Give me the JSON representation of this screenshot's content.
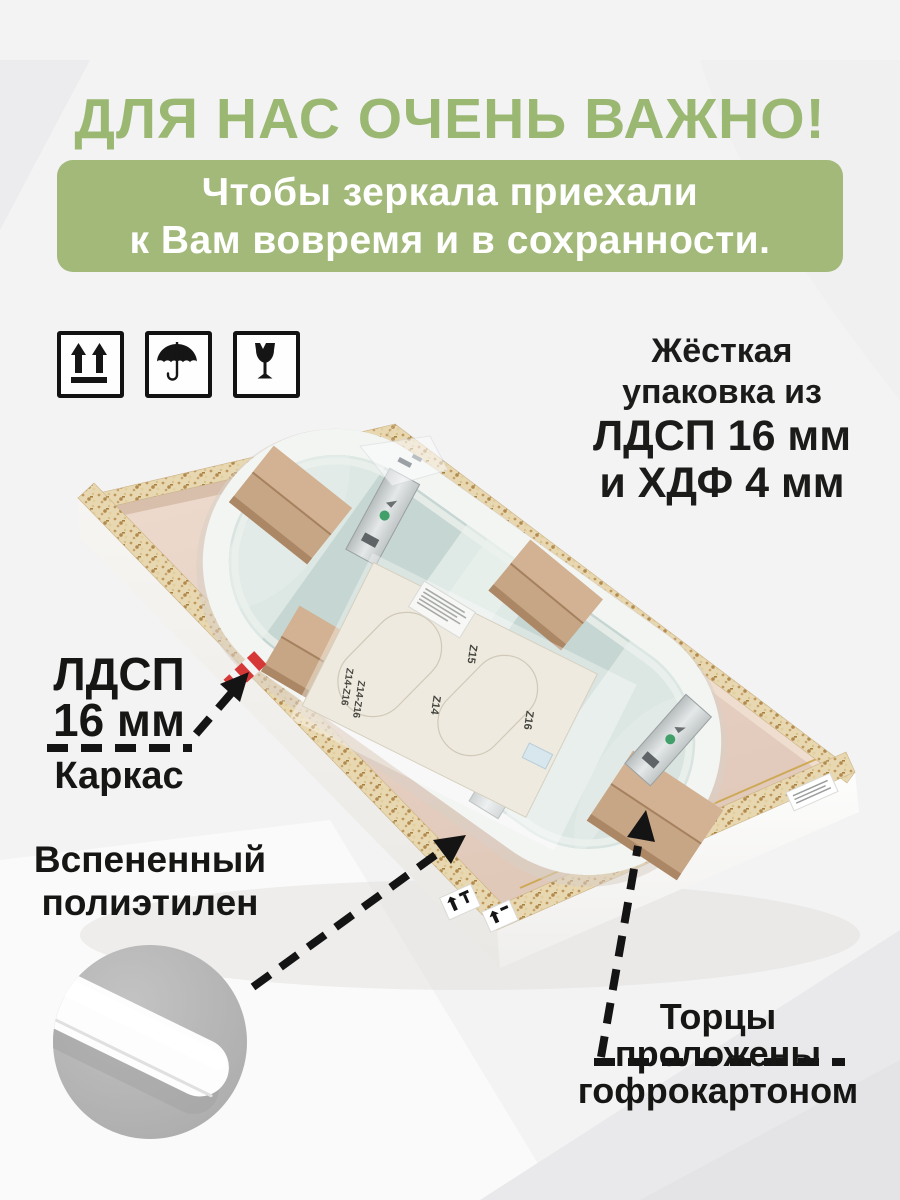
{
  "colors": {
    "accent_green": "#9bb873",
    "banner_green": "#a2b97a",
    "text_dark": "#1b1b19",
    "mirror_back": "#c6d6d2",
    "foam_white": "#f3f5f3",
    "cardboard": "#c7a685",
    "chipboard": "#e8d8b2"
  },
  "header": {
    "title": "ДЛЯ НАС ОЧЕНЬ ВАЖНО!",
    "banner_line1": "Чтобы зеркала приехали",
    "banner_line2": "к Вам вовремя и в сохранности."
  },
  "handling_icons": {
    "this_way_up": "this-way-up",
    "keep_dry": "keep-dry-umbrella",
    "fragile": "fragile-glass"
  },
  "packaging_note": {
    "line1": "Жёсткая",
    "line2": "упаковка из",
    "line3": "ЛДСП 16 мм",
    "line4": "и ХДФ 4 мм"
  },
  "callout_frame": {
    "material": "ЛДСП",
    "thickness": "16 мм",
    "label": "Каркас"
  },
  "callout_foam": {
    "line1": "Вспененный",
    "line2": "полиэтилен"
  },
  "callout_edges": {
    "line1": "Торцы",
    "line2": "проложены",
    "line3": "гофрокартоном"
  },
  "assembly_template": {
    "mark_left_a": "Z14-Z16",
    "mark_left_b": "Z14-Z16",
    "mark_top": "Z15",
    "mark_mid": "Z14",
    "mark_right": "Z16"
  }
}
